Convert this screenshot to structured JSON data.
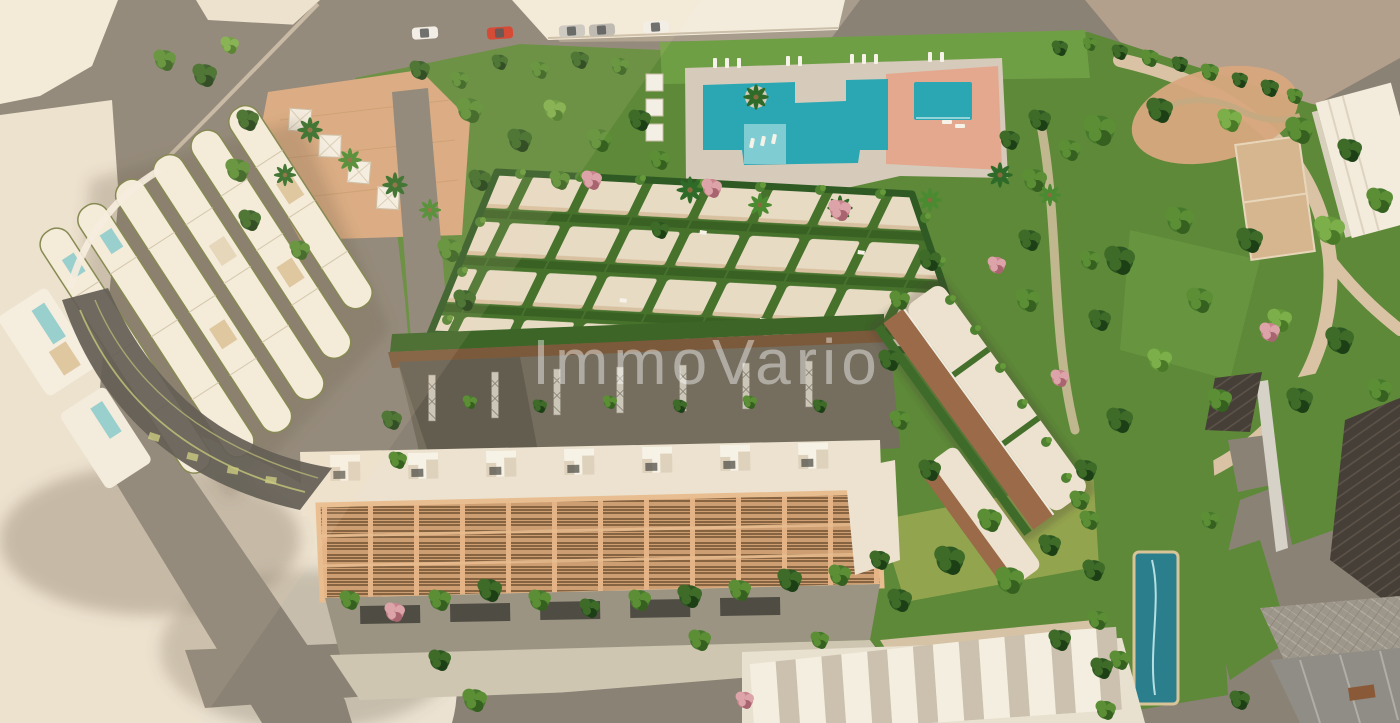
{
  "watermark": {
    "text": "ImmoVario",
    "opacity": "0.42"
  },
  "palette": {
    "roadGray": "#8a8275",
    "roadLight": "#a89d8d",
    "sidewalk": "#cfc3ae",
    "creamLot": "#ebe2d1",
    "creamBright": "#f3ebdc",
    "taupe": "#b3a08c",
    "parkGreen": "#5d8938",
    "lawnLight": "#6f9f45",
    "meadow": "#93a44e",
    "treeDark": "#2d5722",
    "treeMid": "#47792c",
    "treeLight": "#66993a",
    "treePink": "#c8838d",
    "poolTurquoise": "#2ba7b4",
    "poolShelf": "#7fcdd3",
    "lapPool": "#2b7f8d",
    "deckStone": "#d6cabb",
    "deckSalmon": "#e3a88d",
    "terracotta": "#d8a87e",
    "pergolaTan": "#cc9e72",
    "pergolaBeam": "#e8bd8f",
    "cellCream": "#e7dbc4",
    "gridGreen": "#46722c",
    "fanRoof": "#f3ecdc",
    "fanEdge": "#7a8148",
    "glassDark": "#53514a",
    "oliveStripe": "#b9bd72",
    "brownTerrace": "#9a6a49",
    "woodWalk": "#7b5a3b",
    "whiteRoof": "#ece2cf",
    "tileDark": "#463f37",
    "grayRoof": "#8f8d85",
    "wmColor": "#ffffff"
  }
}
